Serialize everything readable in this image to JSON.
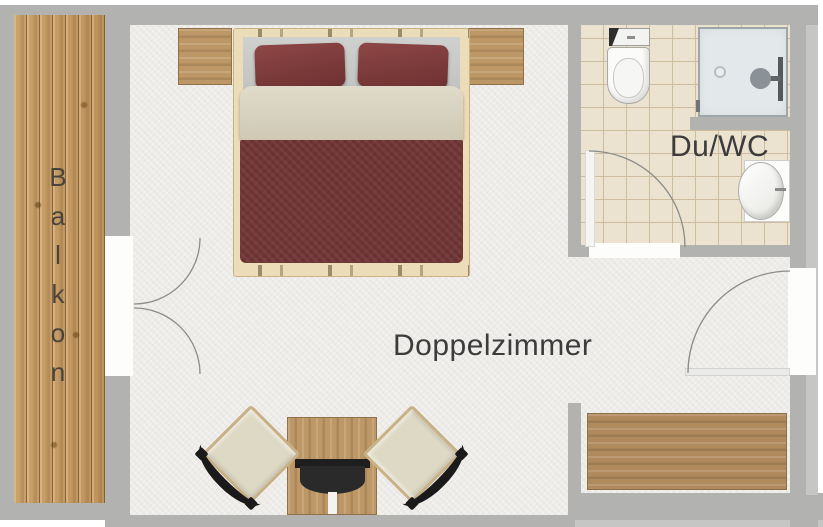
{
  "rooms": {
    "balcony": {
      "label": "Balkon"
    },
    "bedroom": {
      "label": "Doppelzimmer"
    },
    "bathroom": {
      "label": "Du/WC"
    }
  },
  "fixtures": [
    "double-bed",
    "nightstand-left",
    "nightstand-right",
    "table",
    "tv",
    "chair-left",
    "chair-right",
    "sideboard",
    "toilet",
    "shower",
    "sink",
    "balcony-double-door",
    "bathroom-door",
    "entry-door"
  ],
  "colors": {
    "wall": "#b2b2b0",
    "wall_light": "#c6c6c4",
    "floor": "#efedea",
    "balcony_wood": "#c49a62",
    "furniture_wood": "#bd9765",
    "furniture_wood_dark": "#8f7048",
    "bed_frame": "#eddcb8",
    "bed_blanket": "#713535",
    "bed_pillow": "#833d3d",
    "bed_sheet": "#d9d3c1",
    "headboard": "#c9cbc9",
    "tile": "#ebe3d0",
    "tile_line": "#cdbd9d",
    "shower": "#e3e8eb",
    "shower_border": "#9fa6aa",
    "fixture_white": "#fbfbf9",
    "fixture_border": "#a8a8a6",
    "tv_dark": "#1e1e1e",
    "chair_seat": "#ded9c4",
    "chair_frame": "#c9b187",
    "chair_back": "#1a1a1a",
    "label_text": "#3c3c3c",
    "balkon_text": "#49433b",
    "door_arc": "#8c8c88",
    "door_white": "#fdfdfc"
  }
}
